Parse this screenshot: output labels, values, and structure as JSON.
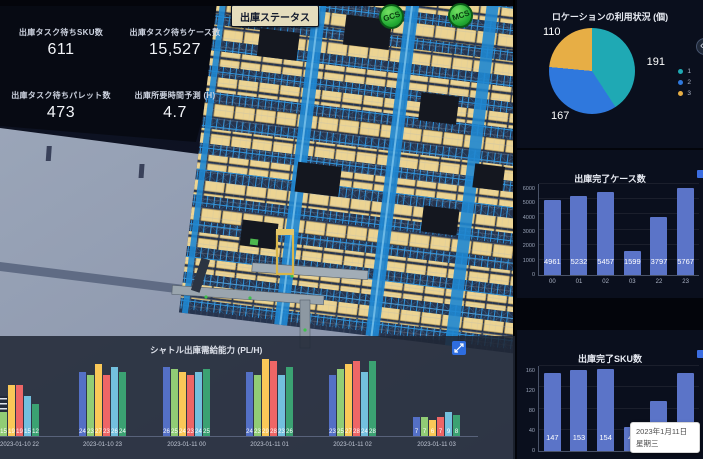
{
  "app": {
    "name": "warehouse-outbound-dashboard"
  },
  "header": {
    "status_button_label": "出庫ステータス",
    "badges": [
      "GCS",
      "MCS"
    ]
  },
  "kpis": [
    {
      "label": "出庫タスク待ちSKU数",
      "value": "611"
    },
    {
      "label": "出庫タスク待ちケース数",
      "value": "15,527"
    },
    {
      "label": "出庫タスク待ちパレット数",
      "value": "473"
    },
    {
      "label": "出庫所要時間予測 (H)",
      "value": "4.7"
    }
  ],
  "icons": {
    "collapse_glyph": "‹"
  },
  "tooltip": {
    "date": "2023年1月11日",
    "weekday": "星期三"
  },
  "chart_data": [
    {
      "id": "location_usage",
      "type": "pie",
      "title": "ロケーションの利用状況 (個)",
      "legend": [
        "1",
        "2",
        "3"
      ],
      "legend_position": "right",
      "values": [
        191,
        167,
        110
      ],
      "colors": [
        "#1fa9b4",
        "#2f78dd",
        "#e7ae45"
      ]
    },
    {
      "id": "completed_cases",
      "type": "bar",
      "title": "出庫完了ケース数",
      "categories": [
        "00",
        "01",
        "02",
        "03",
        "22",
        "23"
      ],
      "values": [
        4961,
        5232,
        5457,
        1599,
        3797,
        5767
      ],
      "ylim": [
        0,
        6000
      ],
      "yticks": [
        0,
        1000,
        2000,
        3000,
        4000,
        5000,
        6000
      ],
      "bar_color": "#5b74c8",
      "grid": true
    },
    {
      "id": "completed_sku",
      "type": "bar",
      "title": "出庫完了SKU数",
      "values": [
        147,
        153,
        154,
        46,
        95,
        147
      ],
      "ylim": [
        0,
        160
      ],
      "yticks": [
        0,
        40,
        80,
        120,
        160
      ],
      "bar_color": "#5b74c8",
      "grid": true
    },
    {
      "id": "shuttle_capacity",
      "type": "grouped-bar",
      "title": "シャトル出庫需給能力 (PL/H)",
      "categories": [
        "2023-01-10 22",
        "2023-01-10 23",
        "2023-01-11 00",
        "2023-01-11 01",
        "2023-01-11 02",
        "2023-01-11 03"
      ],
      "ylim": [
        0,
        30
      ],
      "series": [
        {
          "name": "series-1",
          "color": "#5470c6",
          "values": [
            null,
            24,
            26,
            24,
            23,
            7
          ]
        },
        {
          "name": "series-2",
          "color": "#91cc75",
          "values": [
            15,
            23,
            25,
            23,
            25,
            7
          ]
        },
        {
          "name": "series-3",
          "color": "#fac858",
          "values": [
            19,
            27,
            24,
            29,
            27,
            6
          ]
        },
        {
          "name": "series-4",
          "color": "#ee6666",
          "values": [
            19,
            23,
            23,
            28,
            28,
            7
          ]
        },
        {
          "name": "series-5",
          "color": "#73c0de",
          "values": [
            15,
            26,
            24,
            23,
            24,
            9
          ]
        },
        {
          "name": "series-6",
          "color": "#3ba272",
          "values": [
            12,
            24,
            25,
            26,
            28,
            8
          ]
        }
      ]
    }
  ]
}
